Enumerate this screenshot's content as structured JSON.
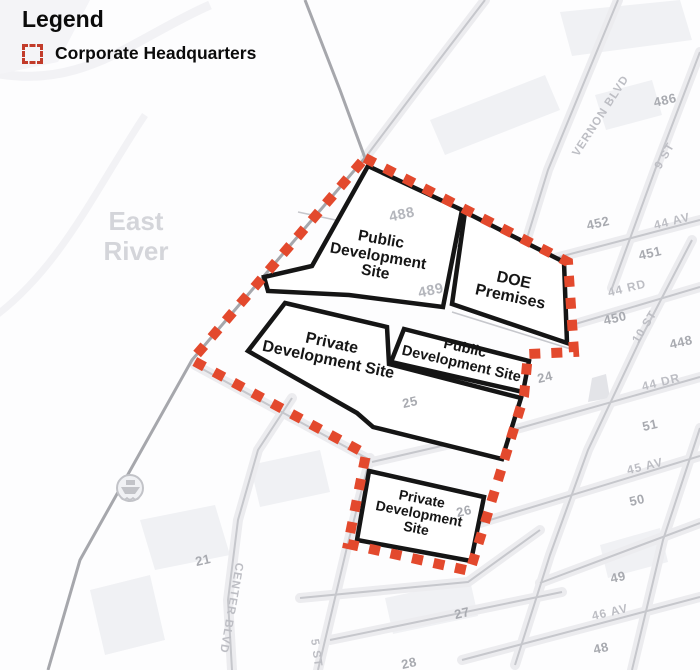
{
  "legend": {
    "title": "Legend",
    "item_label": "Corporate Headquarters"
  },
  "water": {
    "line1": "East",
    "line2": "River"
  },
  "sites": [
    {
      "id": "public-development-site-north",
      "lines": [
        "Public",
        "Development",
        "Site"
      ]
    },
    {
      "id": "doe-premises",
      "lines": [
        "DOE",
        "Premises"
      ]
    },
    {
      "id": "private-development-site-central",
      "lines": [
        "Private",
        "Development Site"
      ]
    },
    {
      "id": "public-development-site-small",
      "lines": [
        "Public",
        "Development Site"
      ]
    },
    {
      "id": "private-development-site-south",
      "lines": [
        "Private",
        "Development",
        "Site"
      ]
    }
  ],
  "streets": [
    {
      "id": "vernon-blvd",
      "label": "VERNON BLVD"
    },
    {
      "id": "9-st",
      "label": "9 ST"
    },
    {
      "id": "44-av",
      "label": "44 AV"
    },
    {
      "id": "44-rd",
      "label": "44 RD"
    },
    {
      "id": "10-st",
      "label": "10 ST"
    },
    {
      "id": "44-dr",
      "label": "44 DR"
    },
    {
      "id": "45-av",
      "label": "45 AV"
    },
    {
      "id": "46-av",
      "label": "46 AV"
    },
    {
      "id": "center-blvd",
      "label": "CENTER BLVD"
    },
    {
      "id": "5-st",
      "label": "5 ST"
    }
  ],
  "blocks": [
    {
      "label": "486"
    },
    {
      "label": "452"
    },
    {
      "label": "451"
    },
    {
      "label": "450"
    },
    {
      "label": "448"
    },
    {
      "label": "51"
    },
    {
      "label": "50"
    },
    {
      "label": "49"
    },
    {
      "label": "48"
    },
    {
      "label": "24"
    },
    {
      "label": "25"
    },
    {
      "label": "26"
    },
    {
      "label": "27"
    },
    {
      "label": "28"
    },
    {
      "label": "21"
    }
  ],
  "parcels": [
    {
      "label": "488"
    },
    {
      "label": "489"
    }
  ],
  "colors": {
    "boundary_red": "#e3492d",
    "legend_red": "#c23b2a",
    "site_outline": "#151515",
    "street_gray": "#c6c7cc",
    "shoreline_gray": "#a6a7ac",
    "block_label_gray": "#a8aab0",
    "street_label_gray": "#bdbec4",
    "water_label_gray": "#d4d5da"
  }
}
